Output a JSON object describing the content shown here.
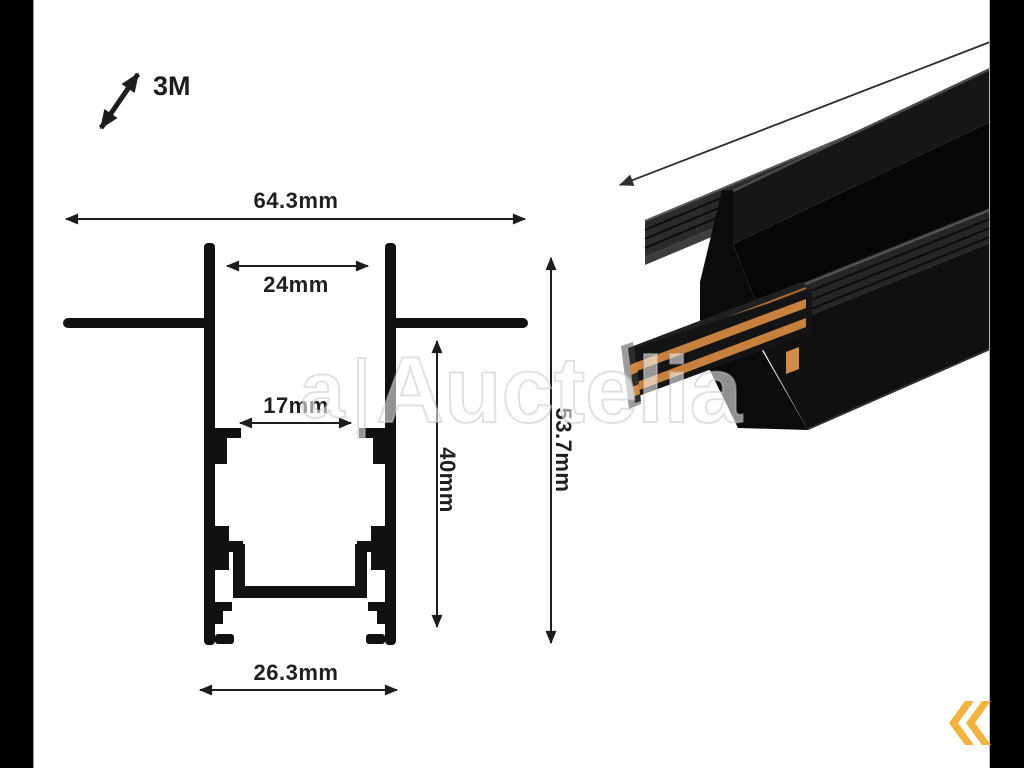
{
  "labels": {
    "length": "3M",
    "overall_width": "64.3mm",
    "opening_width": "24mm",
    "inner_width": "17mm",
    "recess_depth": "40mm",
    "overall_height": "53.7mm",
    "base_width": "26.3mm"
  },
  "watermark": {
    "logo_glyph": "a",
    "separator": "|",
    "text": "Auctelia"
  },
  "colors": {
    "drawing_line": "#1d1d1d",
    "profile_fill": "#111111",
    "copper": "#c8803e",
    "copper_light": "#d08a45",
    "chevron_yellow": "#f2b440",
    "letterbox": "#000000"
  },
  "icons": {
    "length_arrow": "diagonal-double-arrow",
    "nav_back": "double-chevron-left"
  }
}
